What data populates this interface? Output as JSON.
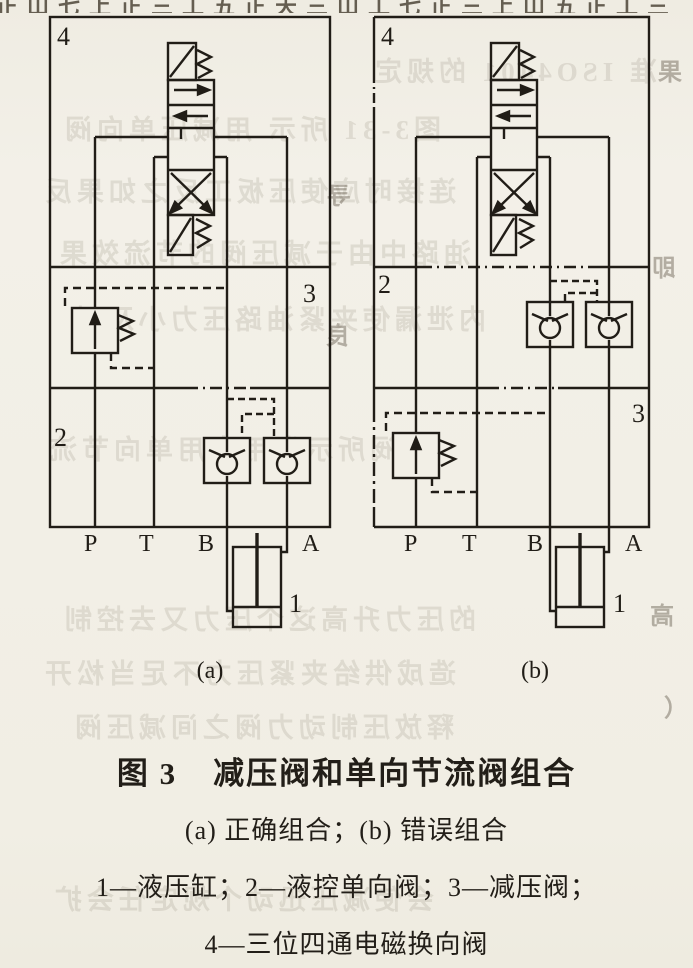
{
  "page": {
    "paper": "#f2efe6",
    "ink": "#211d17"
  },
  "figure_caption": {
    "fig_label": "图 3",
    "title": "减压阀和单向节流阀组合",
    "subcaption": "(a) 正确组合；(b) 错误组合",
    "legend1": "1—液压缸；2—液控单向阀；3—减压阀；",
    "legend2": "4—三位四通电磁换向阀"
  },
  "diagram_a": {
    "sublabel": "(a)",
    "callouts": {
      "k4": "4",
      "k3": "3",
      "k2": "2",
      "k1": "1"
    },
    "ports": {
      "p": "P",
      "t": "T",
      "b": "B",
      "a": "A"
    }
  },
  "diagram_b": {
    "sublabel": "(b)",
    "callouts": {
      "k4": "4",
      "k2": "2",
      "k3": "3",
      "k1": "1"
    },
    "ports": {
      "p": "P",
      "t": "T",
      "b": "B",
      "a": "A"
    }
  },
  "bleedthrough": {
    "top_row": "正山七上正三工五正天三山工七正三上山五正工三",
    "rows": [
      "准 ISO4401 的规定",
      "图3-31 所示 用减压单向阀",
      "连接时应使压板工反之如果反",
      "油路中由于减压阀的节流效果",
      "内泄漏使夹紧油路压力小及时",
      "阀所示为用来用单向节流",
      "的压力升高这个压力又去控制",
      "造成供给夹紧压力不足当松开",
      "释放压制动力阀之间减压阀",
      "会使减压迅动个规定任会扩"
    ],
    "spots": [
      "果",
      "即",
      "寻",
      "良",
      "高",
      "（"
    ]
  }
}
